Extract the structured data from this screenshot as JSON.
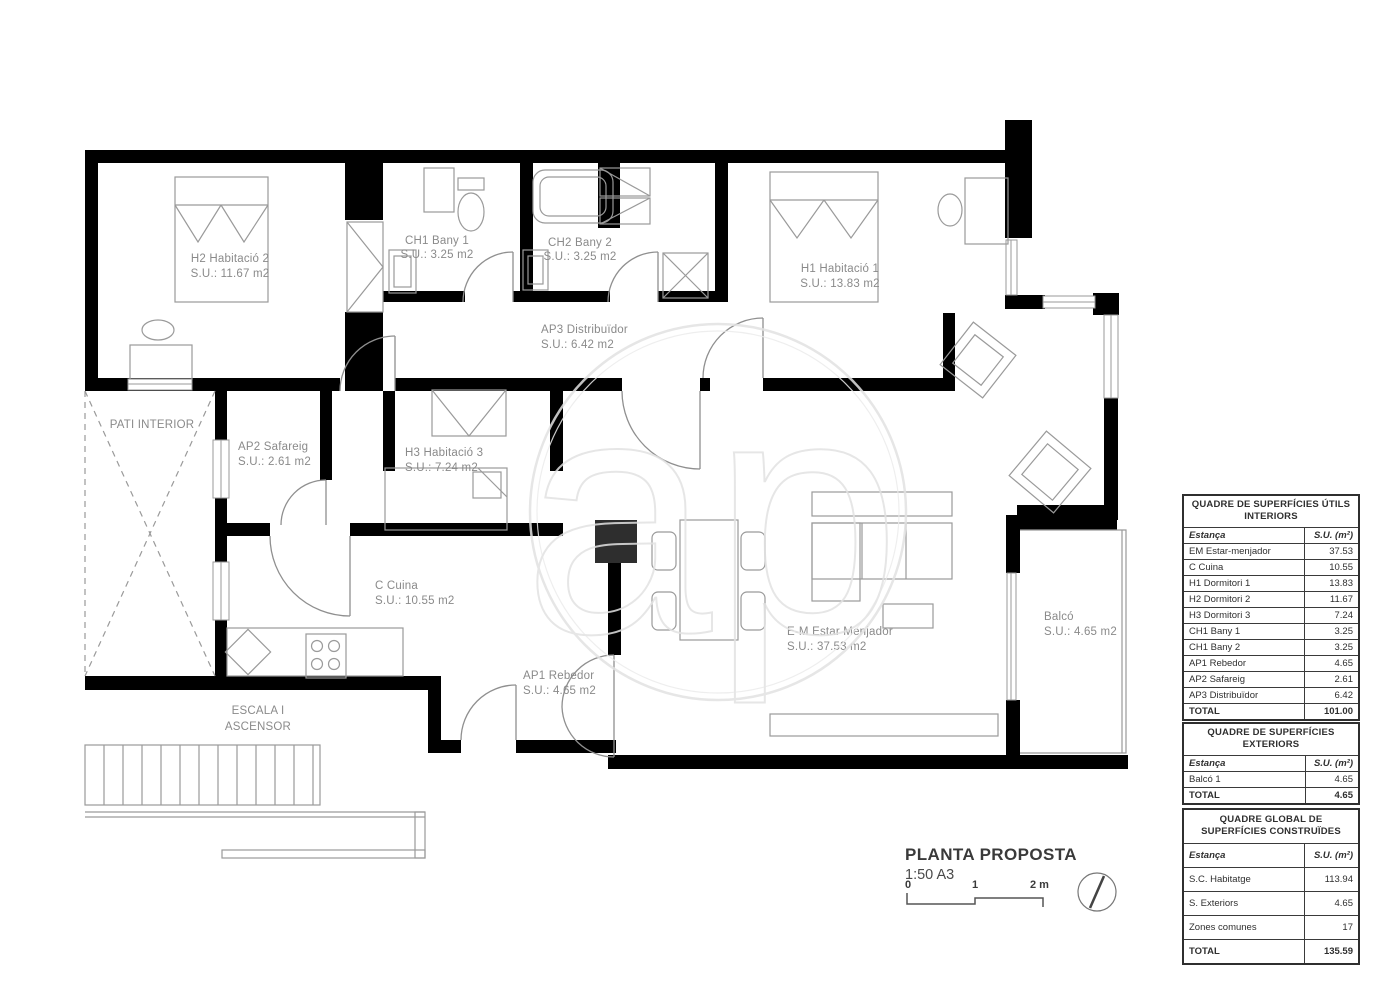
{
  "watermark": {
    "text": "ap"
  },
  "colors": {
    "wall": "#000000",
    "pillar": "#2e2e2e",
    "drawing_line": "#9a9a9a",
    "label_text": "#8a8a8a",
    "table_border": "#3a3a3a",
    "watermark_line": "#e2e2e2"
  },
  "plan": {
    "rooms": {
      "h2": {
        "name": "H2  Habitació 2",
        "su": "S.U.: 11.67 m2"
      },
      "ch1": {
        "name": "CH1 Bany 1",
        "su": "S.U.: 3.25 m2"
      },
      "ch2": {
        "name": "CH2  Bany 2",
        "su": "S.U.: 3.25 m2"
      },
      "h1": {
        "name": "H1 Habitació 1",
        "su": "S.U.: 13.83 m2"
      },
      "ap3": {
        "name": "AP3 Distribuïdor",
        "su": "S.U.: 6.42 m2"
      },
      "pati": {
        "name": "PATI INTERIOR"
      },
      "ap2": {
        "name": "AP2 Safareig",
        "su": "S.U.: 2.61 m2"
      },
      "h3": {
        "name": "H3 Habitació 3",
        "su": "S.U.: 7.24 m2"
      },
      "cuina": {
        "name": "C Cuina",
        "su": "S.U.: 10.55 m2"
      },
      "em": {
        "name": "E-M Estar Menjador",
        "su": "S.U.: 37.53 m2"
      },
      "ap1": {
        "name": "AP1 Rebedor",
        "su": "S.U.: 4.65 m2"
      },
      "balco": {
        "name": "Balcó",
        "su": "S.U.: 4.65 m2"
      },
      "escala": {
        "line1": "ESCALA I",
        "line2": "ASCENSOR"
      }
    }
  },
  "tables": {
    "interiors": {
      "title": "QUADRE DE SUPERFÍCIES ÚTILS INTERIORS",
      "col_room": "Estança",
      "col_su": "S.U. (m²)",
      "rows": [
        {
          "label": "EM Estar-menjador",
          "value": "37.53"
        },
        {
          "label": "C Cuina",
          "value": "10.55"
        },
        {
          "label": "H1 Dormitori 1",
          "value": "13.83"
        },
        {
          "label": "H2 Dormitori 2",
          "value": "11.67"
        },
        {
          "label": "H3 Dormitori 3",
          "value": "7.24"
        },
        {
          "label": "CH1 Bany 1",
          "value": "3.25"
        },
        {
          "label": "CH1 Bany 2",
          "value": "3.25"
        },
        {
          "label": "AP1 Rebedor",
          "value": "4.65"
        },
        {
          "label": "AP2 Safareig",
          "value": "2.61"
        },
        {
          "label": "AP3 Distribuïdor",
          "value": "6.42"
        }
      ],
      "total_label": "TOTAL",
      "total_value": "101.00"
    },
    "exteriors": {
      "title": "QUADRE DE SUPERFÍCIES EXTERIORS",
      "col_room": "Estança",
      "col_su": "S.U. (m²)",
      "rows": [
        {
          "label": "Balcó 1",
          "value": "4.65"
        }
      ],
      "total_label": "TOTAL",
      "total_value": "4.65"
    },
    "global": {
      "title": "QUADRE GLOBAL DE SUPERFÍCIES CONSTRUÏDES",
      "col_room": "Estança",
      "col_su": "S.U. (m²)",
      "rows": [
        {
          "label": "S.C. Habitatge",
          "value": "113.94"
        },
        {
          "label": "S. Exteriors",
          "value": "4.65"
        },
        {
          "label": "Zones comunes",
          "value": "17"
        }
      ],
      "total_label": "TOTAL",
      "total_value": "135.59"
    }
  },
  "title_block": {
    "title": "PLANTA PROPOSTA",
    "scale": "1:50 A3",
    "tick0": "0",
    "tick1": "1",
    "tick2": "2 m"
  }
}
